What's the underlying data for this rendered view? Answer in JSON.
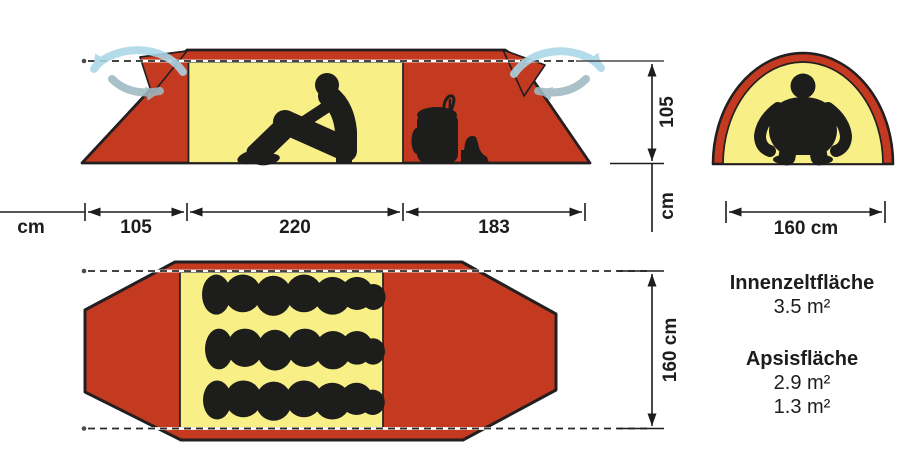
{
  "colors": {
    "tent_red": "#c43a20",
    "inner_yellow": "#f8f087",
    "silhouette_black": "#1d1d1b",
    "airflow_out_blue": "#a9d7e8",
    "airflow_in_gray": "#9fb9c2"
  },
  "bottom_axis": {
    "unit_label": "cm",
    "segments": [
      {
        "label": "105"
      },
      {
        "label": "220"
      },
      {
        "label": "183"
      }
    ]
  },
  "side_view": {
    "height_label": "105",
    "height_unit_label": "cm"
  },
  "front_view": {
    "width_label": "160 cm"
  },
  "floor_plan": {
    "depth_label": "160 cm"
  },
  "info_panel": {
    "inner_area_label": "Innenzeltfläche",
    "inner_area_value": "3.5 m²",
    "apse_area_label": "Apsisfläche",
    "apse_area_value_1": "2.9 m²",
    "apse_area_value_2": "1.3 m²"
  }
}
